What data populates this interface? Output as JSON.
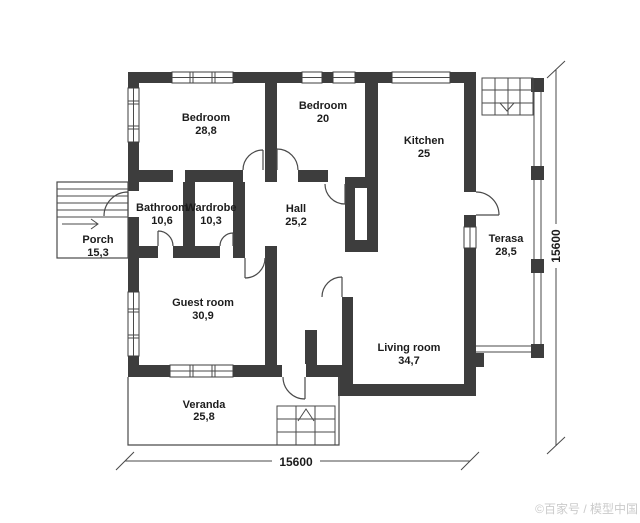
{
  "plan": {
    "title": "House floor plan",
    "rooms": [
      {
        "id": "bedroom-1",
        "name": "Bedroom",
        "area": "28,8"
      },
      {
        "id": "bedroom-2",
        "name": "Bedroom",
        "area": "20"
      },
      {
        "id": "kitchen",
        "name": "Kitchen",
        "area": "25"
      },
      {
        "id": "bathroom",
        "name": "Bathroom",
        "area": "10,6"
      },
      {
        "id": "wardrobe",
        "name": "Wardrobe",
        "area": "10,3"
      },
      {
        "id": "hall",
        "name": "Hall",
        "area": "25,2"
      },
      {
        "id": "porch",
        "name": "Porch",
        "area": "15,3"
      },
      {
        "id": "terasa",
        "name": "Terasa",
        "area": "28,5"
      },
      {
        "id": "guest-room",
        "name": "Guest room",
        "area": "30,9"
      },
      {
        "id": "living-room",
        "name": "Living room",
        "area": "34,7"
      },
      {
        "id": "veranda",
        "name": "Veranda",
        "area": "25,8"
      }
    ],
    "dimensions": {
      "bottom": "15600",
      "right": "15600"
    },
    "watermark": "©百家号 / 模型中国",
    "colors": {
      "wall": "#3d3d3d",
      "line": "#4a4a4a",
      "text": "#1c1c1c",
      "watermark": "#cbcbcb",
      "background": "#ffffff"
    }
  }
}
